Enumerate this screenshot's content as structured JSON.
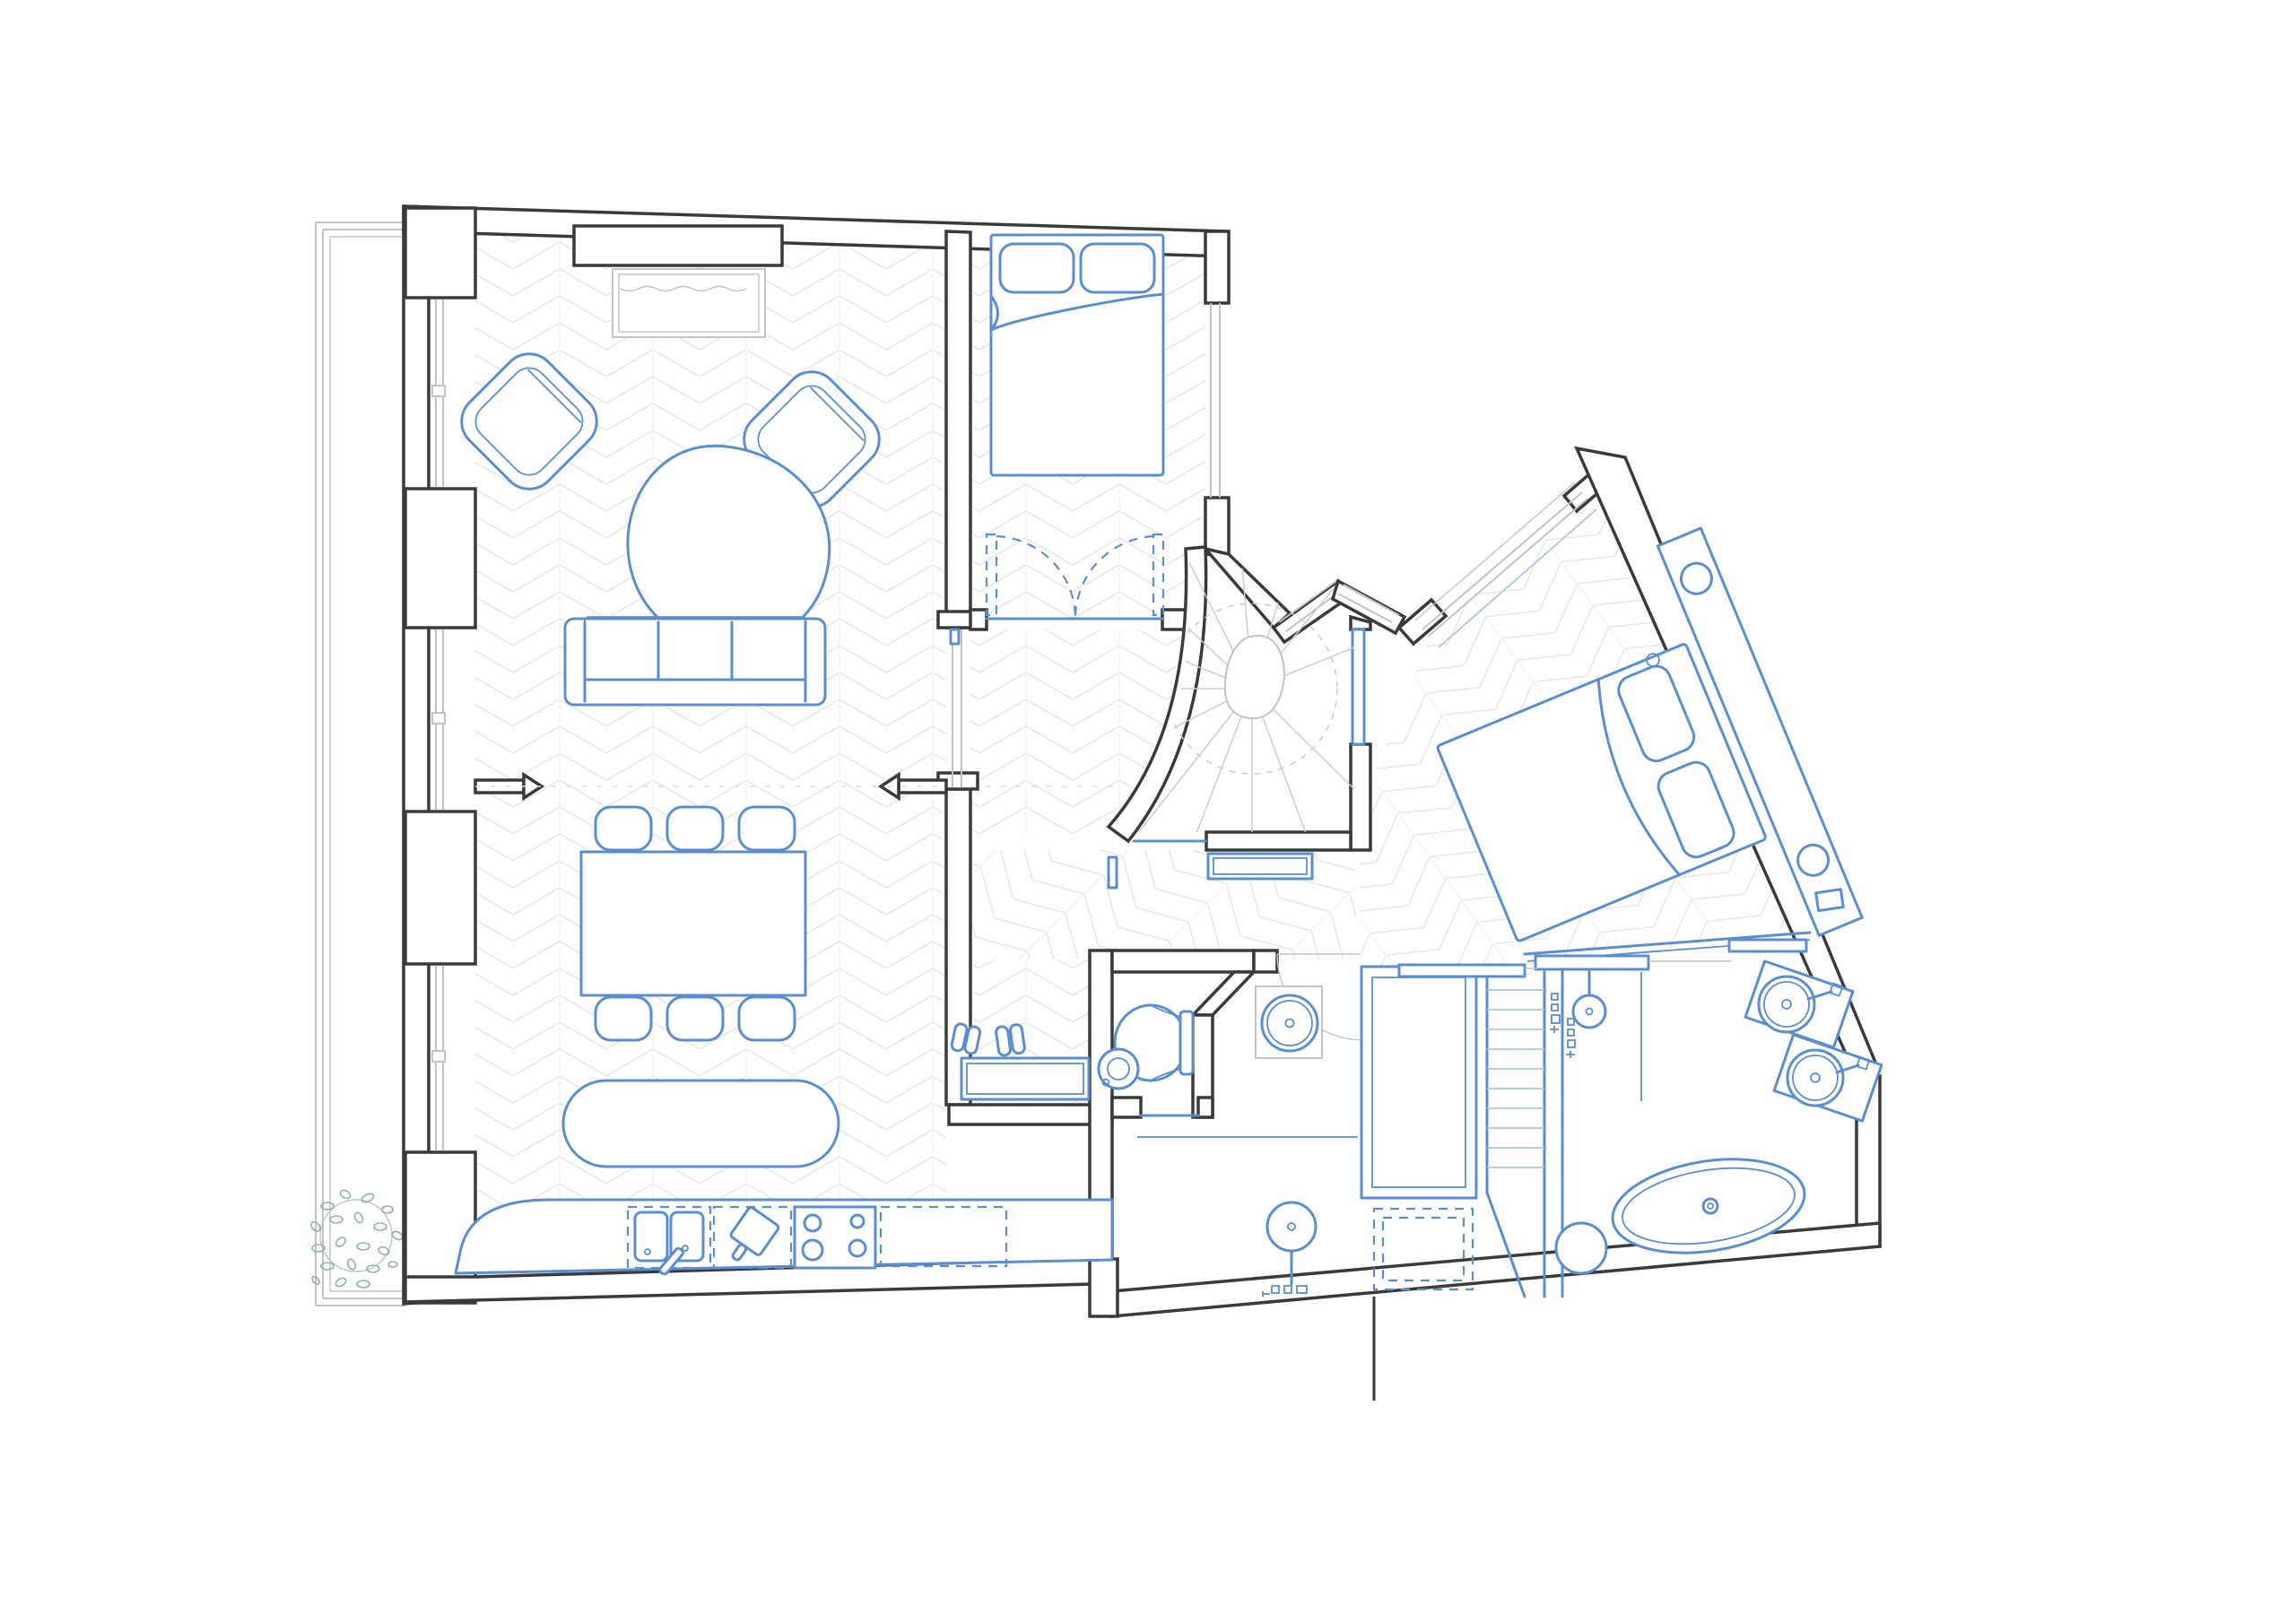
{
  "document": {
    "type": "architectural-floor-plan",
    "description": "Furnished apartment floor plan, plan view. Existing walls in dark grey, new elements and furniture in blue, herringbone parquet hatching in light grey, terrace with plant at lower left.",
    "scale_text": "",
    "visible_text": []
  },
  "palette": {
    "background": "#ffffff",
    "wall": "#3a3a3a",
    "furniture_blue": "#5b8ed0",
    "furniture_blue_light": "#a9c6e8",
    "window_gray": "#c2c2c2",
    "hatch_gray": "#e3e3e3",
    "plant_green": "#8ab79a"
  },
  "rooms": [
    {
      "name": "living-dining-kitchen",
      "floor": "herringbone-parquet-vertical",
      "furniture": [
        "fireplace",
        "armchair",
        "armchair",
        "coffee-table",
        "sofa",
        "dining-table",
        "six-chairs",
        "kitchen-island",
        "kitchen-counter",
        "double-sink",
        "cutting-board",
        "hob"
      ]
    },
    {
      "name": "bedroom-north",
      "floor": "herringbone-parquet-vertical",
      "furniture": [
        "double-bed",
        "pillows",
        "wardrobe-double-doors"
      ]
    },
    {
      "name": "stair-vestibule",
      "floor": "winder-stair-treads",
      "furniture": [
        "winding-stair",
        "newel",
        "bench"
      ]
    },
    {
      "name": "entry-hall",
      "floor": "herringbone-parquet-diagonal",
      "furniture": [
        "bench",
        "console",
        "shoes",
        "radiator"
      ]
    },
    {
      "name": "corridor",
      "floor": "herringbone-parquet-vertical",
      "furniture": [
        "console",
        "shoes"
      ]
    },
    {
      "name": "wc",
      "floor": "plain",
      "furniture": [
        "toilet",
        "corner-basin"
      ]
    },
    {
      "name": "shower-room",
      "floor": "plain",
      "furniture": [
        "round-basin",
        "washstand",
        "shower-head",
        "controls"
      ]
    },
    {
      "name": "dressing",
      "floor": "plain",
      "furniture": [
        "walk-in-closet",
        "washing-machine",
        "shelf-ladder"
      ]
    },
    {
      "name": "bedroom-east",
      "floor": "herringbone-parquet-rotated",
      "furniture": [
        "double-bed-rotated",
        "pillows",
        "headboard-shelf",
        "reading-lights",
        "nightstand"
      ]
    },
    {
      "name": "bathroom",
      "floor": "plain",
      "furniture": [
        "freestanding-bathtub",
        "round-vanity",
        "round-vanity",
        "shower-head",
        "glass-screen",
        "stool",
        "shelves"
      ]
    },
    {
      "name": "terrace",
      "floor": "plain",
      "furniture": [
        "plant"
      ]
    }
  ]
}
